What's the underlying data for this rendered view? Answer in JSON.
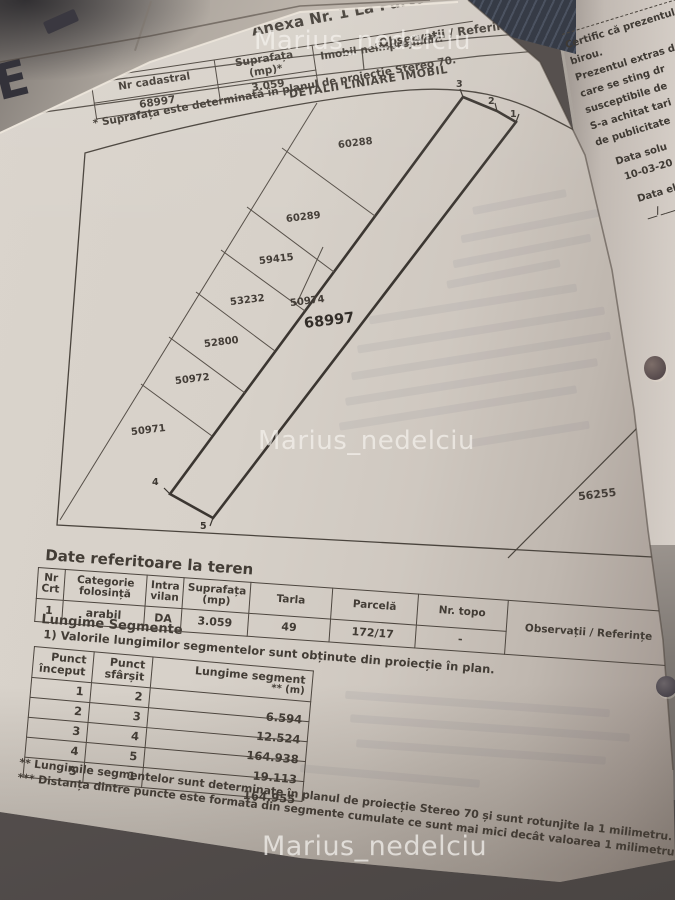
{
  "watermarks": {
    "text": "Marius_nedelciu"
  },
  "header": {
    "title": "Anexa Nr. 1 La Partea I",
    "observations": "Observații / Referințe",
    "top_fragment": "Ca"
  },
  "teren": {
    "label": "Teren",
    "col_cadastral": "Nr cadastral",
    "col_area": "Suprafața (mp)*",
    "cadastral_no": "68997",
    "area": "3.059",
    "building_note": "Imobil neimprejmuit.",
    "footnote": "* Suprafața este determinată în planul de proiecție Stereo 70.",
    "plan_title": "DETALII LINIARE IMOBIL"
  },
  "plan": {
    "main_parcel": "68997",
    "corner_parcel": "56255",
    "points": [
      "1",
      "2",
      "3",
      "4",
      "5"
    ],
    "neighbors": [
      "60288",
      "60289",
      "59415",
      "53232",
      "50974",
      "52800",
      "50972",
      "50971"
    ]
  },
  "land_table": {
    "title": "Date referitoare la teren",
    "headers": {
      "crt": "Nr Crt",
      "category": "Categorie folosință",
      "intra": "Intra vilan",
      "area": "Suprafața (mp)",
      "tarla": "Tarla",
      "parcel": "Parcelă",
      "topo": "Nr. topo",
      "obs": "Observații / Referințe"
    },
    "row": {
      "crt": "1",
      "category": "arabil",
      "intra": "DA",
      "area": "3.059",
      "tarla": "49",
      "parcel": "172/17",
      "topo": "-",
      "obs": ""
    }
  },
  "segments": {
    "title": "Lungime Segmente",
    "note": "1) Valorile lungimilor segmentelor sunt obținute din proiecție în plan.",
    "col_start": "Punct început",
    "col_end": "Punct sfârșit",
    "col_length": "Lungime segment",
    "col_unit": "** (m)",
    "rows": [
      {
        "start": "1",
        "end": "2",
        "length": "6.594"
      },
      {
        "start": "2",
        "end": "3",
        "length": "12.524"
      },
      {
        "start": "3",
        "end": "4",
        "length": "164.938"
      },
      {
        "start": "4",
        "end": "5",
        "length": "19.113"
      },
      {
        "start": "5",
        "end": "1",
        "length": "164.955"
      }
    ],
    "footnote2": "** Lungimile segmentelor sunt determinate în planul de proiecție Stereo 70 și sunt rotunjite la 1 milimetru.",
    "footnote3": "*** Distanța dintre puncte este formată din segmente cumulate ce sunt mai mici decât valoarea 1 milimetru."
  },
  "side_page": {
    "lines": [
      "Certific că prezentul",
      "birou.",
      "Prezentul extras d",
      "care se sting dr",
      "susceptibile de",
      "S-a achitat tari",
      "de publicitate"
    ],
    "date_label": "Data solu",
    "date_value": "10-03-20",
    "issue_label": "Data eli",
    "signature": "__/____"
  },
  "corner_letter": "E"
}
